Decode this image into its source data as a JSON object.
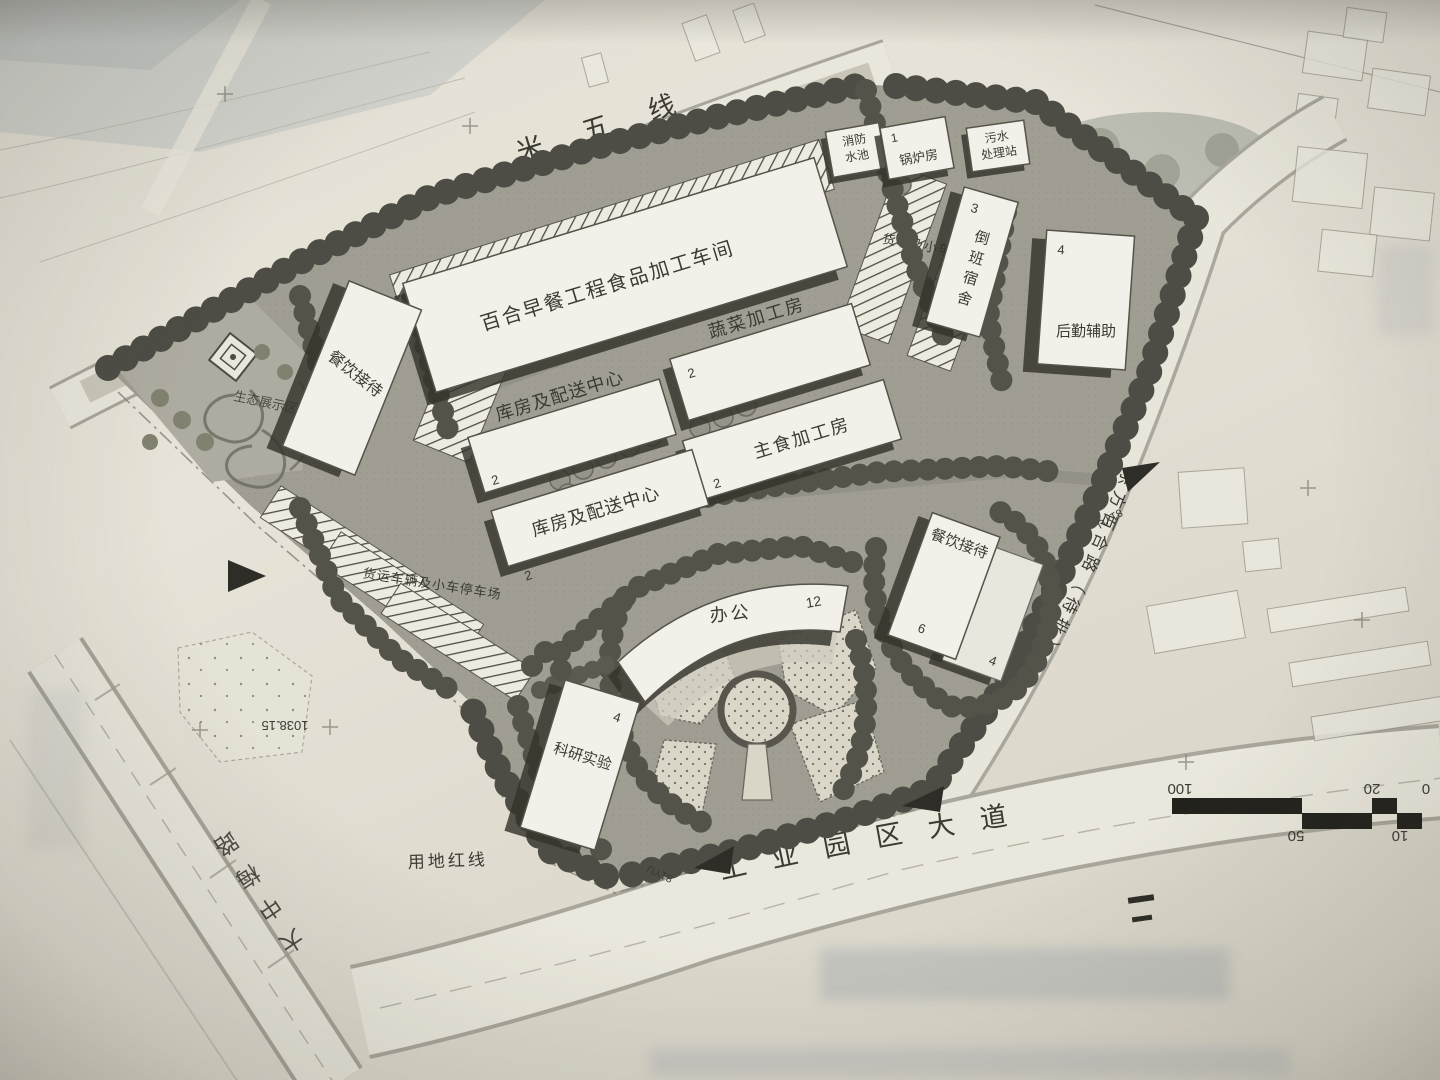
{
  "plan": {
    "roads": {
      "north": "米五线",
      "south": "工业园区大道",
      "east": "东方百合路（待批）",
      "west": "大中梅路"
    },
    "boundary": {
      "red_line": "用地红线"
    },
    "survey": {
      "elevation": "1038.15",
      "marker_a": "81YU",
      "marker_b": "81YU"
    },
    "buildings": {
      "workshop": {
        "name": "百合早餐工程食品加工车间"
      },
      "vegetable": {
        "name": "蔬菜加工房",
        "num": "2"
      },
      "staple": {
        "name": "主食加工房",
        "num": "2"
      },
      "warehouse_upper": {
        "name": "库房及配送中心",
        "num": "2"
      },
      "warehouse_lower": {
        "name": "库房及配送中心",
        "num": "2"
      },
      "catering_west": {
        "name": "餐饮接待"
      },
      "catering_east": {
        "name": "餐饮接待",
        "num": "6",
        "annex_num": "4"
      },
      "office": {
        "name": "办公",
        "num": "12"
      },
      "research": {
        "name": "科研实验",
        "num": "4"
      },
      "dormitory": {
        "name": "倒班宿舍",
        "num": "3"
      },
      "logistics": {
        "name": "后勤辅助",
        "num": "4"
      },
      "boiler": {
        "name": "锅炉房",
        "num": "1"
      },
      "fire_pool": {
        "line1": "消防",
        "line2": "水池"
      },
      "sewage": {
        "line1": "污水",
        "line2": "处理站"
      }
    },
    "areas": {
      "eco": "生态展示区",
      "parking_truck": "货车及小车停车场",
      "parking_west": "货运车辆及小车停车场"
    },
    "scale_bar": {
      "labels": [
        "100",
        "50",
        "20",
        "10",
        "0"
      ]
    }
  }
}
